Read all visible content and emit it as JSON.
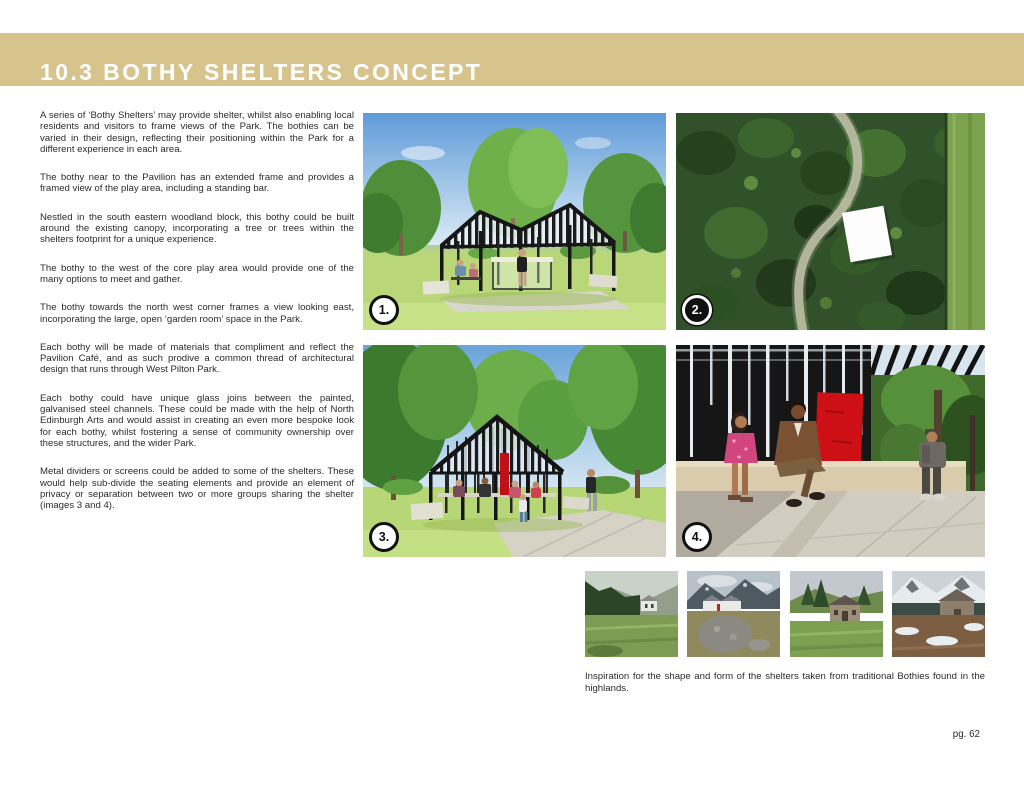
{
  "page": {
    "title": "10.3 BOTHY SHELTERS CONCEPT",
    "page_number": "pg. 62"
  },
  "colors": {
    "accent_tan": "#d6c48c",
    "title_white": "#ffffff",
    "body_text": "#2b2b2b",
    "badge_black": "#101010",
    "divider_red": "#ce1016"
  },
  "body": {
    "paragraphs": [
      "A series of ‘Bothy Shelters’ may provide shelter, whilst also enabling local residents and visitors to frame views of the Park. The bothies can be varied in their design, reflecting their positioning within the Park for a different experience in each area.",
      "The bothy near to the Pavilion has an extended frame and provides a framed view of the play area, including a standing bar.",
      "Nestled in the south eastern woodland block, this bothy could be built around the existing canopy, incorporating a tree or trees within the shelters footprint for a unique experience.",
      "The bothy to the west of the core play area would provide one of the many options to meet and gather.",
      "The bothy towards the north west corner frames a view looking east, incorporating the large, open ‘garden room’ space in the Park.",
      "Each bothy will be made of materials that compliment and reflect the Pavilion Café, and as such prodive a common thread of architectural design that runs through West Pilton Park.",
      "Each bothy could have unique glass joins between the painted, galvanised steel channels. These could be made with the help of North Edinburgh Arts and would assist in creating an even more bespoke look for each bothy, whilst fostering a sense of community ownership over these structures, and the wider Park.",
      "Metal dividers or screens could be added to some of the shelters. These would help sub-divide the seating elements and provide an element of privacy or separation between two or more groups sharing the shelter (images 3 and 4)."
    ]
  },
  "figures": [
    {
      "label": "1."
    },
    {
      "label": "2."
    },
    {
      "label": "3."
    },
    {
      "label": "4."
    }
  ],
  "inspiration": {
    "caption": "Inspiration for the shape and form of the shelters taken from traditional Bothies found in the highlands."
  }
}
